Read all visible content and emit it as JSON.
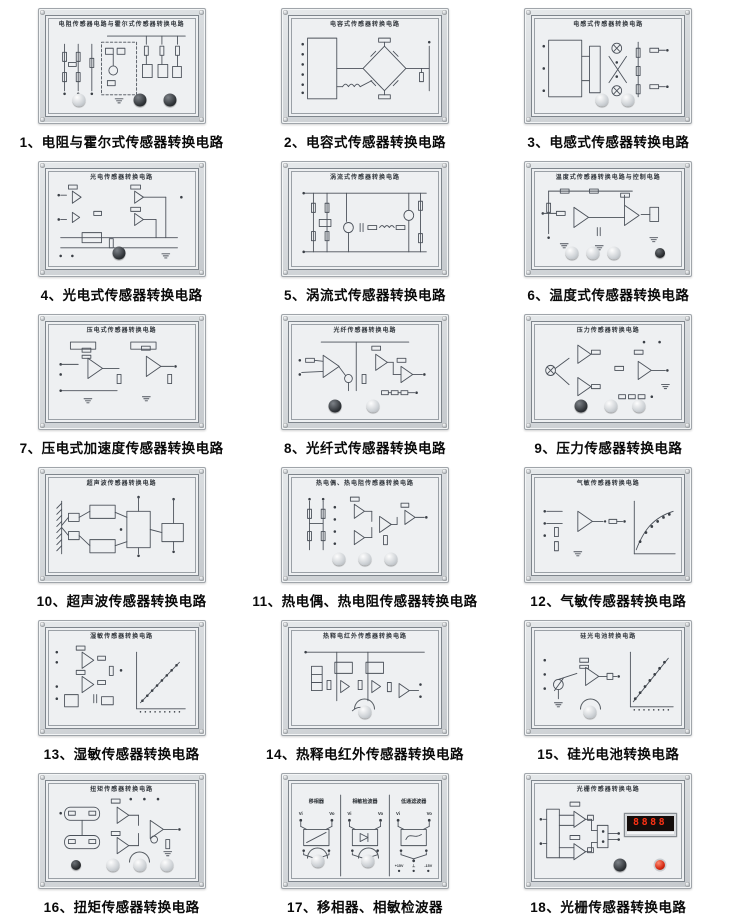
{
  "page": {
    "background": "#ffffff"
  },
  "colors": {
    "panel_frame": "#ccd0d4",
    "panel_face": "#eef0f2",
    "circuit_line": "#4b515a",
    "caption_text": "#0a0a0a",
    "display_digits": "#ff3214",
    "red_button": "#d42812"
  },
  "panels": [
    {
      "num": "1",
      "caption": "1、电阻与霍尔式传感器转换电路",
      "title": "电阻传感器电路与霍尔式传感器转换电路",
      "schematic": "res_hall",
      "knobs": [
        {
          "x": 22,
          "t": "light"
        },
        {
          "x": 62,
          "t": "dark"
        },
        {
          "x": 82,
          "t": "dark"
        }
      ]
    },
    {
      "num": "2",
      "caption": "2、电容式传感器转换电路",
      "title": "电容式传感器转换电路",
      "schematic": "cap_bridge",
      "knobs": []
    },
    {
      "num": "3",
      "caption": "3、电感式传感器转换电路",
      "title": "电感式传感器转换电路",
      "schematic": "ind_bridge",
      "knobs": [
        {
          "x": 46,
          "t": "light"
        },
        {
          "x": 63,
          "t": "light"
        }
      ]
    },
    {
      "num": "4",
      "caption": "4、光电式传感器转换电路",
      "title": "光电传感器转换电路",
      "schematic": "photo_amp",
      "knobs": [
        {
          "x": 48,
          "t": "dark"
        }
      ]
    },
    {
      "num": "5",
      "caption": "5、涡流式传感器转换电路",
      "title": "涡流式传感器转换电路",
      "schematic": "eddy",
      "knobs": []
    },
    {
      "num": "6",
      "caption": "6、温度式传感器转换电路",
      "title": "温度式传感器转换电路与控制电路",
      "schematic": "temp",
      "knobs": [
        {
          "x": 26,
          "t": "light"
        },
        {
          "x": 40,
          "t": "light"
        },
        {
          "x": 54,
          "t": "light"
        },
        {
          "x": 84,
          "t": "darksmall"
        }
      ]
    },
    {
      "num": "7",
      "caption": "7、压电式加速度传感器转换电路",
      "title": "压电式传感器转换电路",
      "schematic": "piezo",
      "knobs": []
    },
    {
      "num": "8",
      "caption": "8、光纤式传感器转换电路",
      "title": "光纤传感器转换电路",
      "schematic": "fiber",
      "knobs": [
        {
          "x": 30,
          "t": "dark"
        },
        {
          "x": 55,
          "t": "light"
        }
      ]
    },
    {
      "num": "9",
      "caption": "9、压力传感器转换电路",
      "title": "压力传感器转换电路",
      "schematic": "pressure",
      "knobs": [
        {
          "x": 32,
          "t": "dark"
        },
        {
          "x": 52,
          "t": "light"
        },
        {
          "x": 70,
          "t": "light"
        }
      ]
    },
    {
      "num": "10",
      "caption": "10、超声波传感器转换电路",
      "title": "超声波传感器转换电路",
      "schematic": "ultrasonic",
      "knobs": []
    },
    {
      "num": "11",
      "caption": "11、热电偶、热电阻传感器转换电路",
      "title": "热电偶、热电阻传感器转换电路",
      "schematic": "thermo",
      "knobs": [
        {
          "x": 33,
          "t": "light"
        },
        {
          "x": 50,
          "t": "light"
        },
        {
          "x": 67,
          "t": "light"
        }
      ]
    },
    {
      "num": "12",
      "caption": "12、气敏传感器转换电路",
      "title": "气敏传感器转换电路",
      "schematic": "gas",
      "knobs": []
    },
    {
      "num": "13",
      "caption": "13、湿敏传感器转换电路",
      "title": "湿敏传感器转换电路",
      "schematic": "humidity",
      "knobs": []
    },
    {
      "num": "14",
      "caption": "14、热释电红外传感器转换电路",
      "title": "热释电红外传感器转换电路",
      "schematic": "pyro",
      "knobs": [
        {
          "x": 50,
          "t": "light",
          "arc": true
        }
      ]
    },
    {
      "num": "15",
      "caption": "15、硅光电池转换电路",
      "title": "硅光电池转换电路",
      "schematic": "silicon",
      "knobs": [
        {
          "x": 38,
          "t": "light",
          "arc": true
        }
      ]
    },
    {
      "num": "16",
      "caption": "16、扭矩传感器转换电路",
      "title": "扭矩传感器转换电路",
      "schematic": "torque",
      "knobs": [
        {
          "x": 20,
          "t": "darksmall"
        },
        {
          "x": 44,
          "t": "light"
        },
        {
          "x": 62,
          "t": "light",
          "arc": true
        },
        {
          "x": 80,
          "t": "light"
        }
      ]
    },
    {
      "num": "17",
      "caption": "17、移相器、相敏检波器",
      "title": "",
      "schematic": "phase",
      "sections": [
        "移相器",
        "相敏检波器",
        "低通滤波器"
      ],
      "labels": {
        "vi": "Vi",
        "vo": "Vo",
        "plus": "+15V",
        "gnd": "⊥",
        "minus": "-15V"
      },
      "knobs": [
        {
          "x": 19,
          "t": "light",
          "arc": true,
          "y": 80
        },
        {
          "x": 52,
          "t": "light",
          "arc": true,
          "y": 80
        }
      ]
    },
    {
      "num": "18",
      "caption": "18、光栅传感器转换电路",
      "title": "光栅传感器转换电路",
      "schematic": "grating",
      "display": "8888",
      "knobs": [
        {
          "x": 58,
          "t": "dark"
        },
        {
          "x": 84,
          "t": "red"
        }
      ]
    }
  ]
}
